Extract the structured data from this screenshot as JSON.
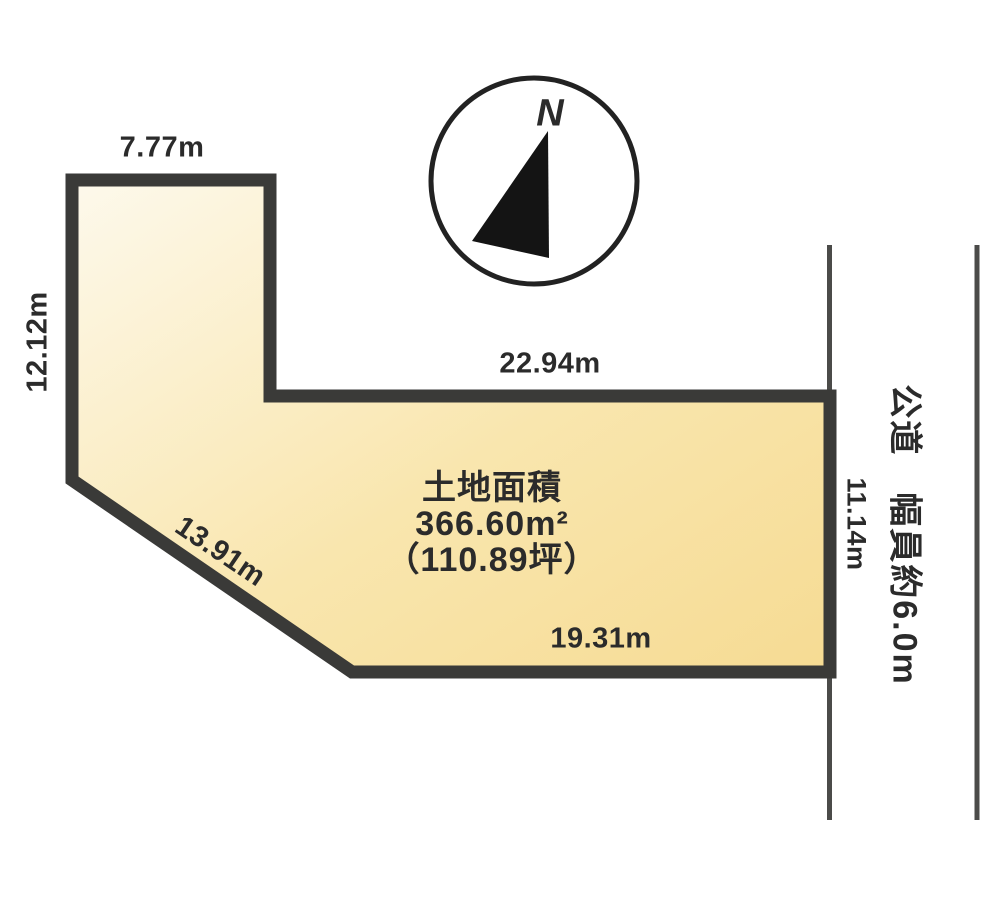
{
  "diagram": {
    "kind": "land-plot-survey-diagram",
    "compass": {
      "north_label": "N"
    },
    "plot": {
      "area_title": "土地面積",
      "area_value": "366.60m²",
      "area_tsubo": "（110.89坪）",
      "dimensions": {
        "top_edge": "7.77m",
        "left_edge": "12.12m",
        "upper_inner_edge": "22.94m",
        "diagonal_edge": "13.91m",
        "bottom_edge": "19.31m",
        "right_edge": "11.14m"
      }
    },
    "road": {
      "label": "公道　幅員約6.0m"
    },
    "colors": {
      "fill_light": "#fdf9ec",
      "fill_mid": "#f9e6ae",
      "fill_dark": "#f6db93",
      "outline": "#3a3a38",
      "road_line": "#4b4b49",
      "text": "#2b2b2b",
      "compass_stroke": "#222222",
      "needle_fill": "#141414"
    }
  }
}
